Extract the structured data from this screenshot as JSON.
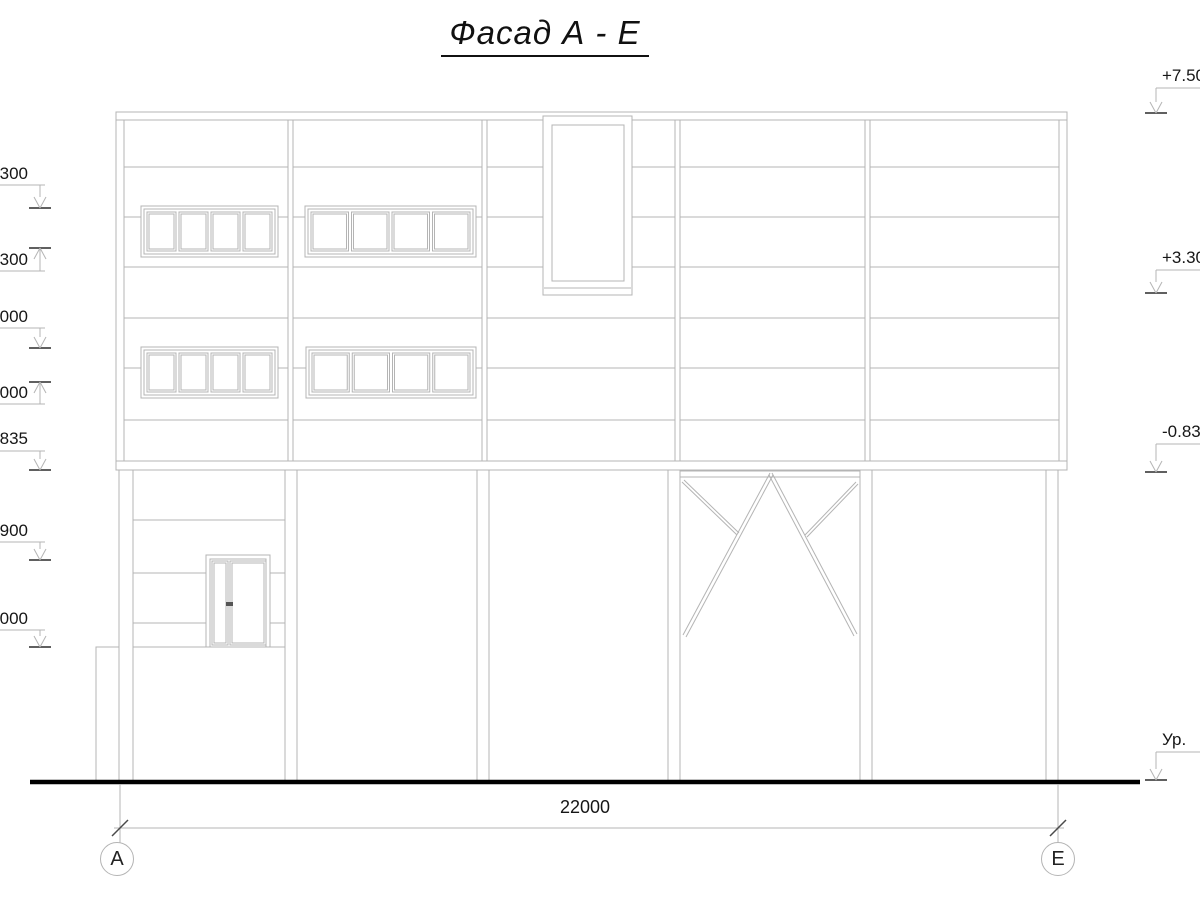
{
  "title": "Фасад А - Е",
  "dimension": {
    "label": "22000"
  },
  "axes": {
    "left": "А",
    "right": "Е"
  },
  "elevation_marks": {
    "left": [
      {
        "label": "300",
        "arrow": "down",
        "text_y": 164,
        "line_y": 185,
        "level": 208
      },
      {
        "label": ".300",
        "arrow": "up",
        "text_y": 250,
        "line_y": 271,
        "level": 248
      },
      {
        "label": "000",
        "arrow": "down",
        "text_y": 307,
        "line_y": 328,
        "level": 348
      },
      {
        "label": ".000",
        "arrow": "up",
        "text_y": 383,
        "line_y": 404,
        "level": 382
      },
      {
        "label": ".835",
        "arrow": "down",
        "text_y": 429,
        "line_y": 451,
        "level": 470
      },
      {
        "label": ".900",
        "arrow": "down",
        "text_y": 521,
        "line_y": 542,
        "level": 560
      },
      {
        "label": ".000",
        "arrow": "down",
        "text_y": 609,
        "line_y": 630,
        "level": 647
      }
    ],
    "right": [
      {
        "label": "+7.50",
        "arrow": "down",
        "text_y": 66,
        "line_y": 88,
        "level": 113
      },
      {
        "label": "+3.30",
        "arrow": "down",
        "text_y": 248,
        "line_y": 270,
        "level": 293
      },
      {
        "label": "-0.83",
        "arrow": "down",
        "text_y": 422,
        "line_y": 444,
        "level": 472
      },
      {
        "label": "Ур.",
        "arrow": "down",
        "text_y": 730,
        "line_y": 752,
        "level": 780
      }
    ]
  }
}
